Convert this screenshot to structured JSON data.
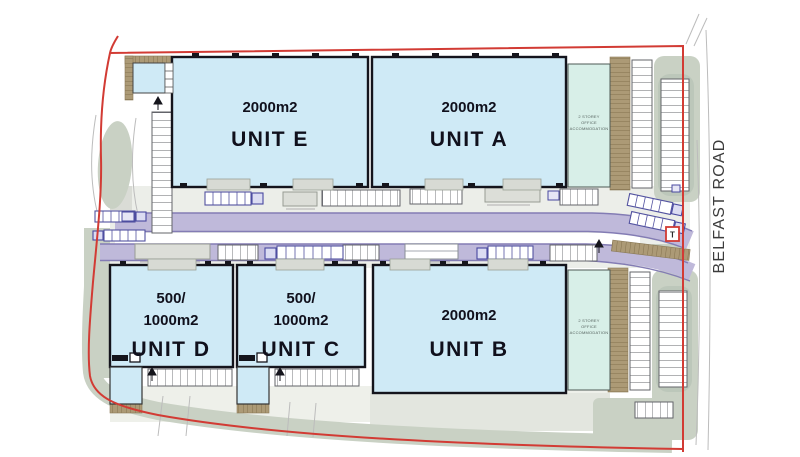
{
  "site_plan": {
    "road_name": "BELFAST ROAD",
    "marker_t": "T",
    "units": {
      "e": {
        "area": "2000m2",
        "name": "UNIT E"
      },
      "a": {
        "area": "2000m2",
        "name": "UNIT A"
      },
      "b": {
        "area": "2000m2",
        "name": "UNIT B"
      },
      "d": {
        "area1": "500/",
        "area2": "1000m2",
        "name": "UNIT D"
      },
      "c": {
        "area1": "500/",
        "area2": "1000m2",
        "name": "UNIT C"
      }
    },
    "offices": {
      "line1": "2 STOREY",
      "line2": "OFFICE",
      "line3": "ACCOMMODATION"
    },
    "colors": {
      "building_fill": "#cfeaf6",
      "office_fill": "#d8efe8",
      "road_fill": "#bfb9da",
      "road_edge": "#837cb4",
      "landscape_green": "#c9d1c4",
      "landscape_brown": "#ac9a76",
      "boundary_red": "#d23b34"
    }
  }
}
